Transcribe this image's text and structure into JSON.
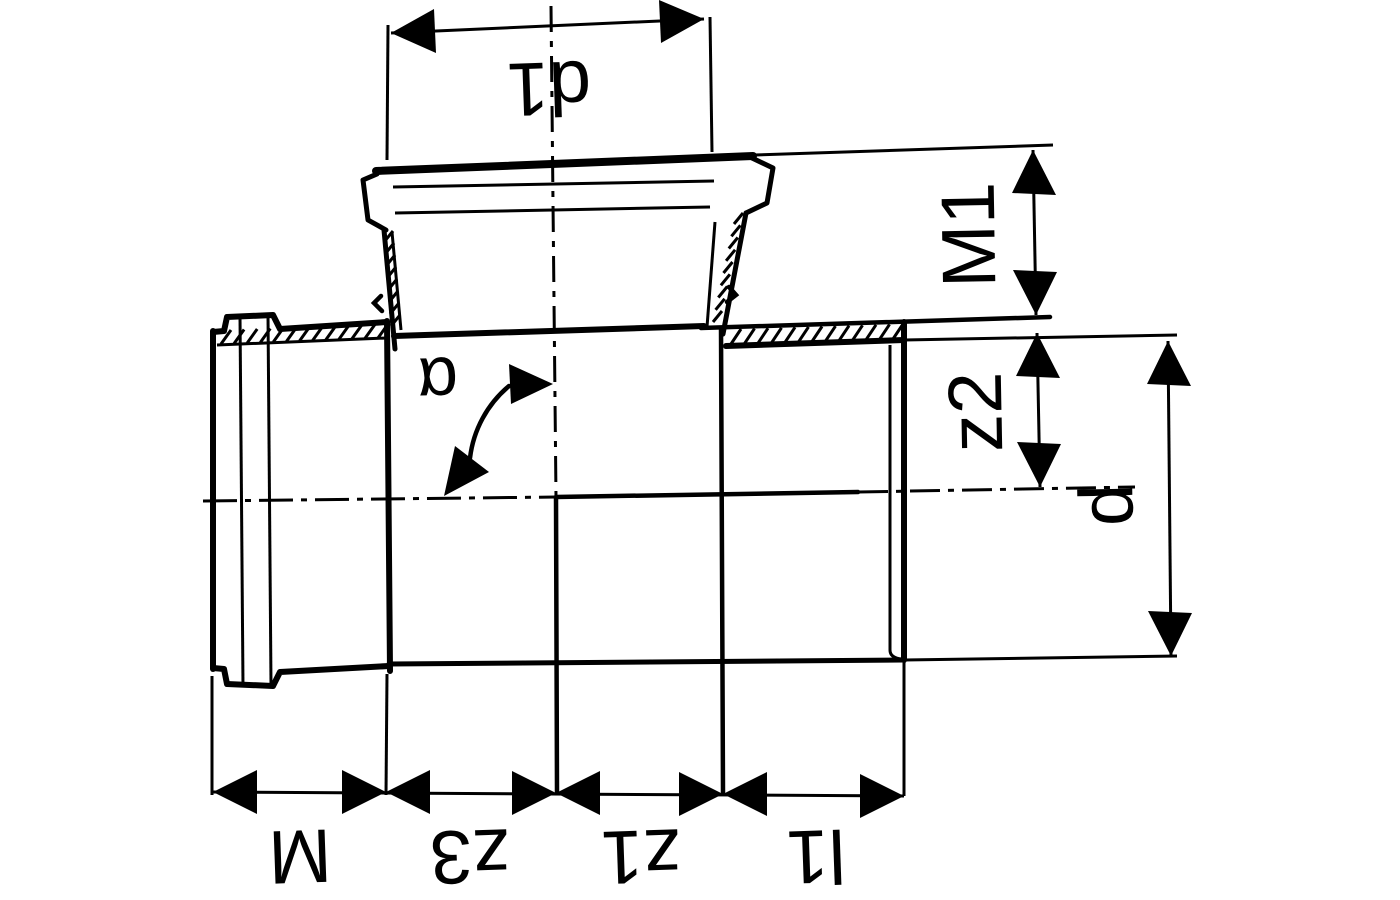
{
  "drawing": {
    "kind": "technical-dimension-drawing",
    "subject": "pipe branch fitting, longitudinal section, image rotated 180 degrees",
    "ink_color": "#000000",
    "background_color": "#ffffff",
    "dims": {
      "d1": {
        "label": "d1"
      },
      "M1": {
        "label": "M1"
      },
      "z2": {
        "label": "z2"
      },
      "d": {
        "label": "d"
      },
      "alpha": {
        "label": "α"
      },
      "M": {
        "label": "M"
      },
      "z3": {
        "label": "z3"
      },
      "z1": {
        "label": "z1"
      },
      "l1": {
        "label": "l1"
      }
    }
  }
}
